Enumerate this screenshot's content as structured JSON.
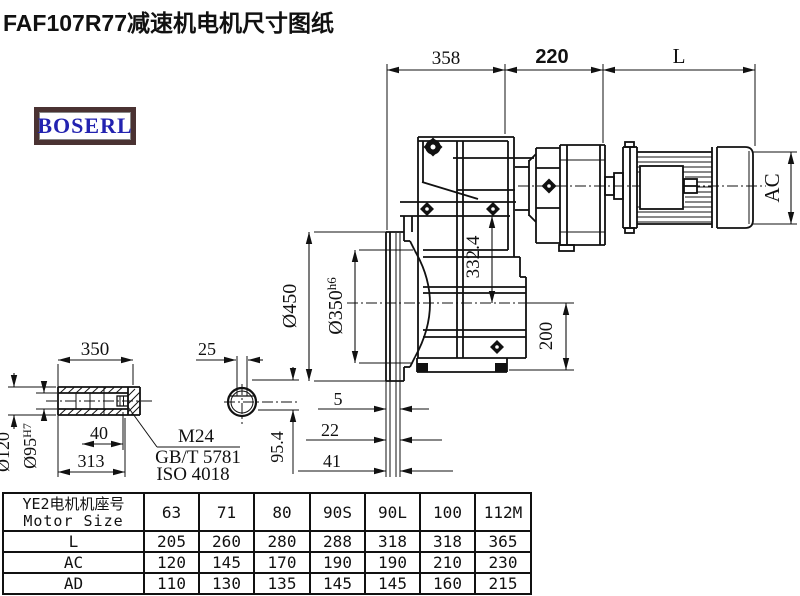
{
  "title": "FAF107R77减速机电机尺寸图纸",
  "logo": {
    "text": "BOSERL"
  },
  "drawing": {
    "dim_gearbox_len": "358",
    "dim_adapter_len": "220",
    "dim_motor_len": "L",
    "dim_motor_dia": "AC",
    "dim_flange_od": "Ø450",
    "dim_spigot": "Ø350",
    "dim_spigot_tol": "h6",
    "dim_height": "332.4",
    "dim_foot_height": "200",
    "dim_off_1": "5",
    "dim_off_2": "22",
    "dim_off_3": "41",
    "dim_shaft_len": "350",
    "dim_key_w": "25",
    "dim_plug": "40",
    "dim_shaft_len2": "313",
    "dim_shaft_od": "Ø120",
    "dim_bore": "Ø95",
    "dim_bore_tol": "H7",
    "dim_key_h": "95.4",
    "note_bolt": "M24",
    "note_std1": "GB/T 5781",
    "note_std2": "ISO 4018"
  },
  "table": {
    "header_cn": "YE2电机机座号",
    "header_en": "Motor Size",
    "columns": [
      "63",
      "71",
      "80",
      "90S",
      "90L",
      "100",
      "112M"
    ],
    "rows": [
      {
        "label": "L",
        "values": [
          "205",
          "260",
          "280",
          "288",
          "318",
          "318",
          "365"
        ]
      },
      {
        "label": "AC",
        "values": [
          "120",
          "145",
          "170",
          "190",
          "190",
          "210",
          "230"
        ]
      },
      {
        "label": "AD",
        "values": [
          "110",
          "130",
          "135",
          "145",
          "145",
          "160",
          "215"
        ]
      }
    ]
  }
}
